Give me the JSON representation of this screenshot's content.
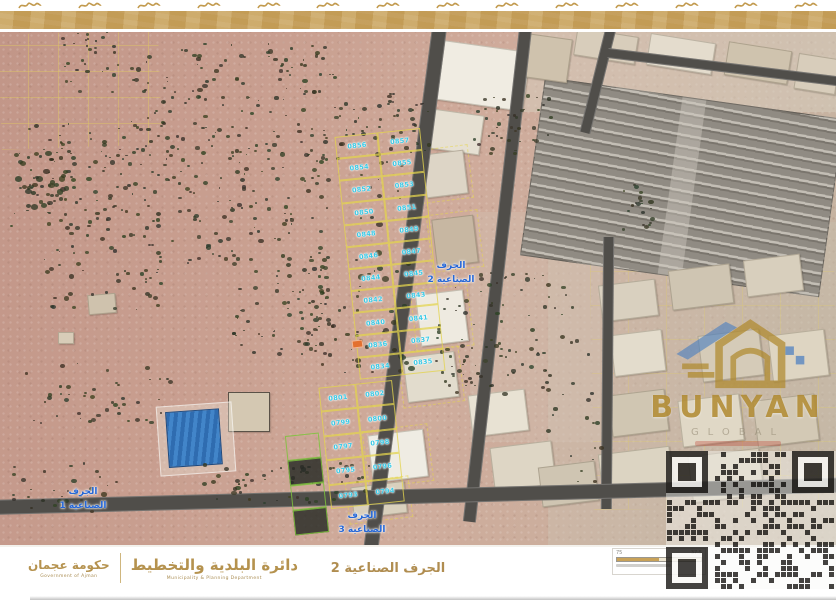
{
  "header": {
    "band_color": "#c9a35c"
  },
  "map": {
    "area_labels": [
      {
        "line1": "الجرف",
        "line2": "الصناعية 1"
      },
      {
        "line1": "الجرف",
        "line2": "الصناعية 2"
      },
      {
        "line1": "الجرف",
        "line2": "الصناعية 3"
      }
    ],
    "plots": {
      "upper": [
        [
          "0856",
          "0857"
        ],
        [
          "0854",
          "0855"
        ],
        [
          "0852",
          "0853"
        ],
        [
          "0850",
          "0851"
        ],
        [
          "0848",
          "0849"
        ],
        [
          "0846",
          "0847"
        ],
        [
          "0844",
          "0845"
        ],
        [
          "0842",
          "0843"
        ],
        [
          "0840",
          "0841"
        ],
        [
          "0836",
          "0837"
        ],
        [
          "0834",
          "0835"
        ]
      ],
      "lower": [
        [
          "0801",
          "0802"
        ],
        [
          "0799",
          "0800"
        ],
        [
          "0797",
          "0798"
        ],
        [
          "0795",
          "0796"
        ],
        [
          "0793",
          "0794"
        ]
      ]
    },
    "colors": {
      "plot_number": "#38c9e6",
      "plot_border": "#e3d44e",
      "area_label": "#2667d6",
      "road": "#504e4a"
    }
  },
  "watermark": {
    "brand": "BUNYAN",
    "subtitle": "GLOBAL",
    "gold": "#b08a2e",
    "blue": "#4a7fc1"
  },
  "footer": {
    "municipality_ar": "دائرة البلدية والتخطيط",
    "municipality_en": "Municipality & Planning Department",
    "government_ar": "حكومة عجمان",
    "government_en": "Government of Ajman",
    "map_title": "الجرف الصناعية 2",
    "scale_left": "75",
    "scale_right": "37.5"
  }
}
